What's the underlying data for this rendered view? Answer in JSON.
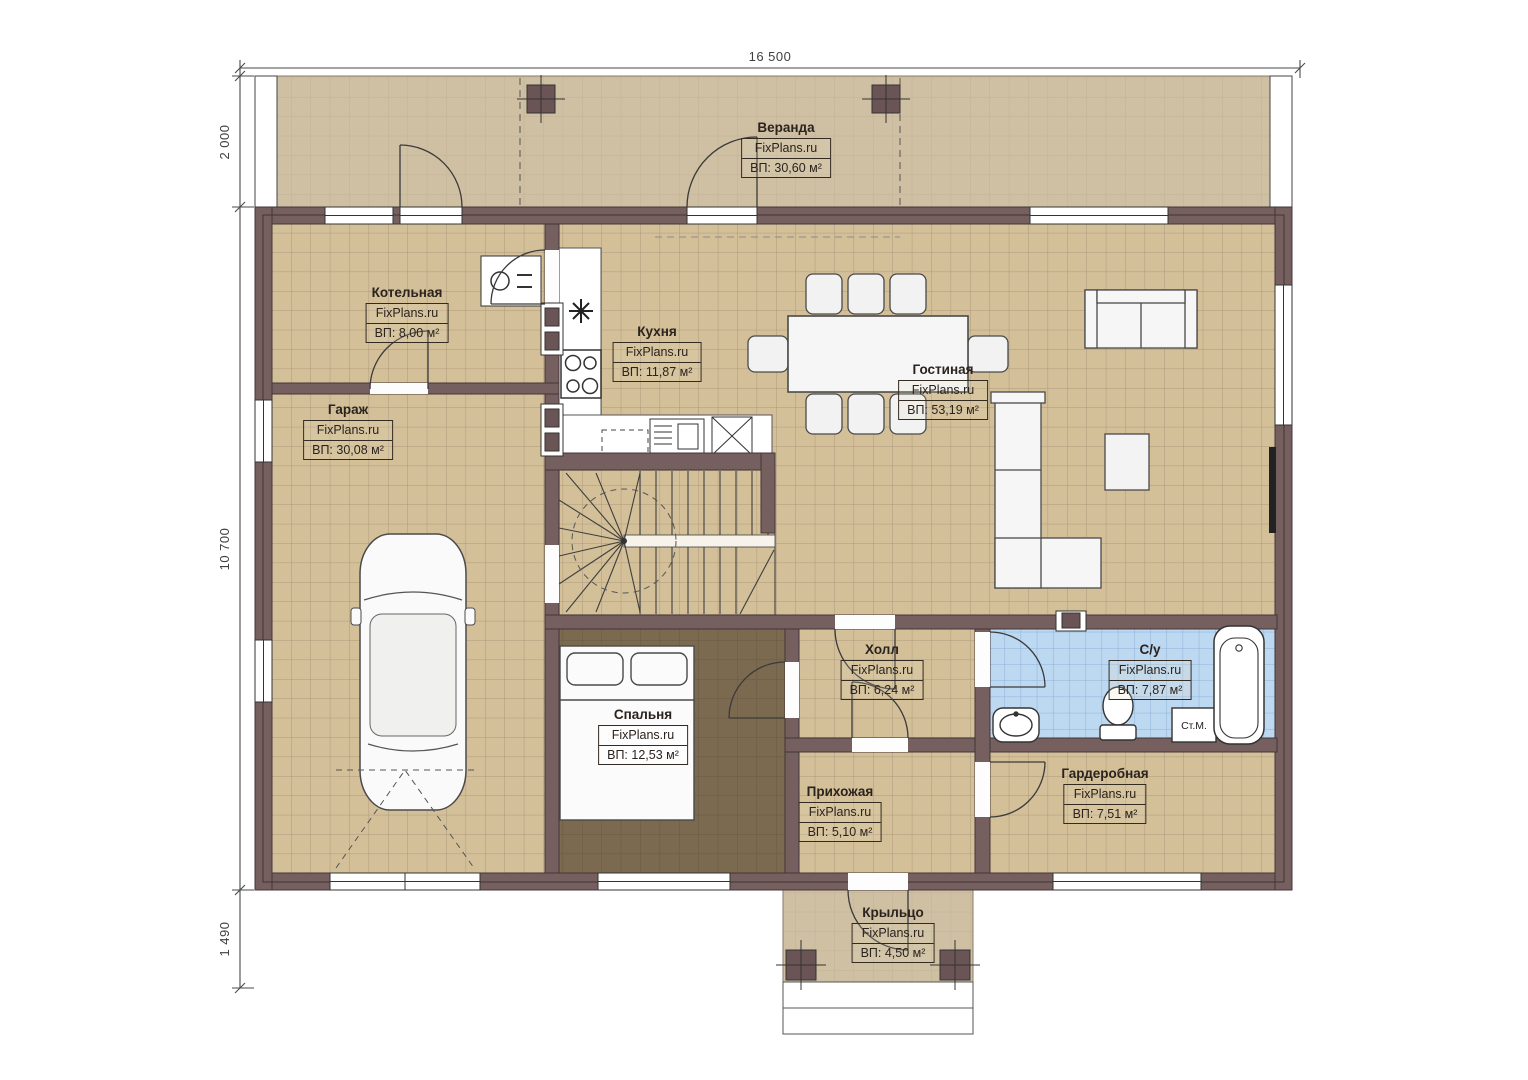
{
  "dimensions": {
    "width_total": "16 500",
    "veranda_depth": "2 000",
    "house_depth": "10 700",
    "porch_depth": "1 490"
  },
  "rooms": [
    {
      "name": "Веранда",
      "brand": "FixPlans.ru",
      "area": "ВП: 30,60 м²"
    },
    {
      "name": "Котельная",
      "brand": "FixPlans.ru",
      "area": "ВП: 8,00 м²"
    },
    {
      "name": "Кухня",
      "brand": "FixPlans.ru",
      "area": "ВП: 11,87 м²"
    },
    {
      "name": "Гостиная",
      "brand": "FixPlans.ru",
      "area": "ВП: 53,19 м²"
    },
    {
      "name": "Гараж",
      "brand": "FixPlans.ru",
      "area": "ВП: 30,08 м²"
    },
    {
      "name": "Спальня",
      "brand": "FixPlans.ru",
      "area": "ВП: 12,53 м²"
    },
    {
      "name": "Холл",
      "brand": "FixPlans.ru",
      "area": "ВП: 6,24 м²"
    },
    {
      "name": "С/у",
      "brand": "FixPlans.ru",
      "area": "ВП: 7,87 м²"
    },
    {
      "name": "Прихожая",
      "brand": "FixPlans.ru",
      "area": "ВП: 5,10 м²"
    },
    {
      "name": "Гардеробная",
      "brand": "FixPlans.ru",
      "area": "ВП: 7,51 м²"
    },
    {
      "name": "Крыльцо",
      "brand": "FixPlans.ru",
      "area": "ВП: 4,50 м²"
    }
  ],
  "fixtures": {
    "washing_machine": "Ст.М."
  },
  "colors": {
    "wall": "#75605f",
    "floor_tile": "#d3c099",
    "floor_grid": "#ad977b",
    "bathroom_tile": "#bdd8f1",
    "bedroom_floor": "#7c6a50",
    "veranda_floor": "#cfc0a3",
    "column": "#6b5456",
    "furniture": "#f6f6f6",
    "line": "#3a3a3a"
  }
}
